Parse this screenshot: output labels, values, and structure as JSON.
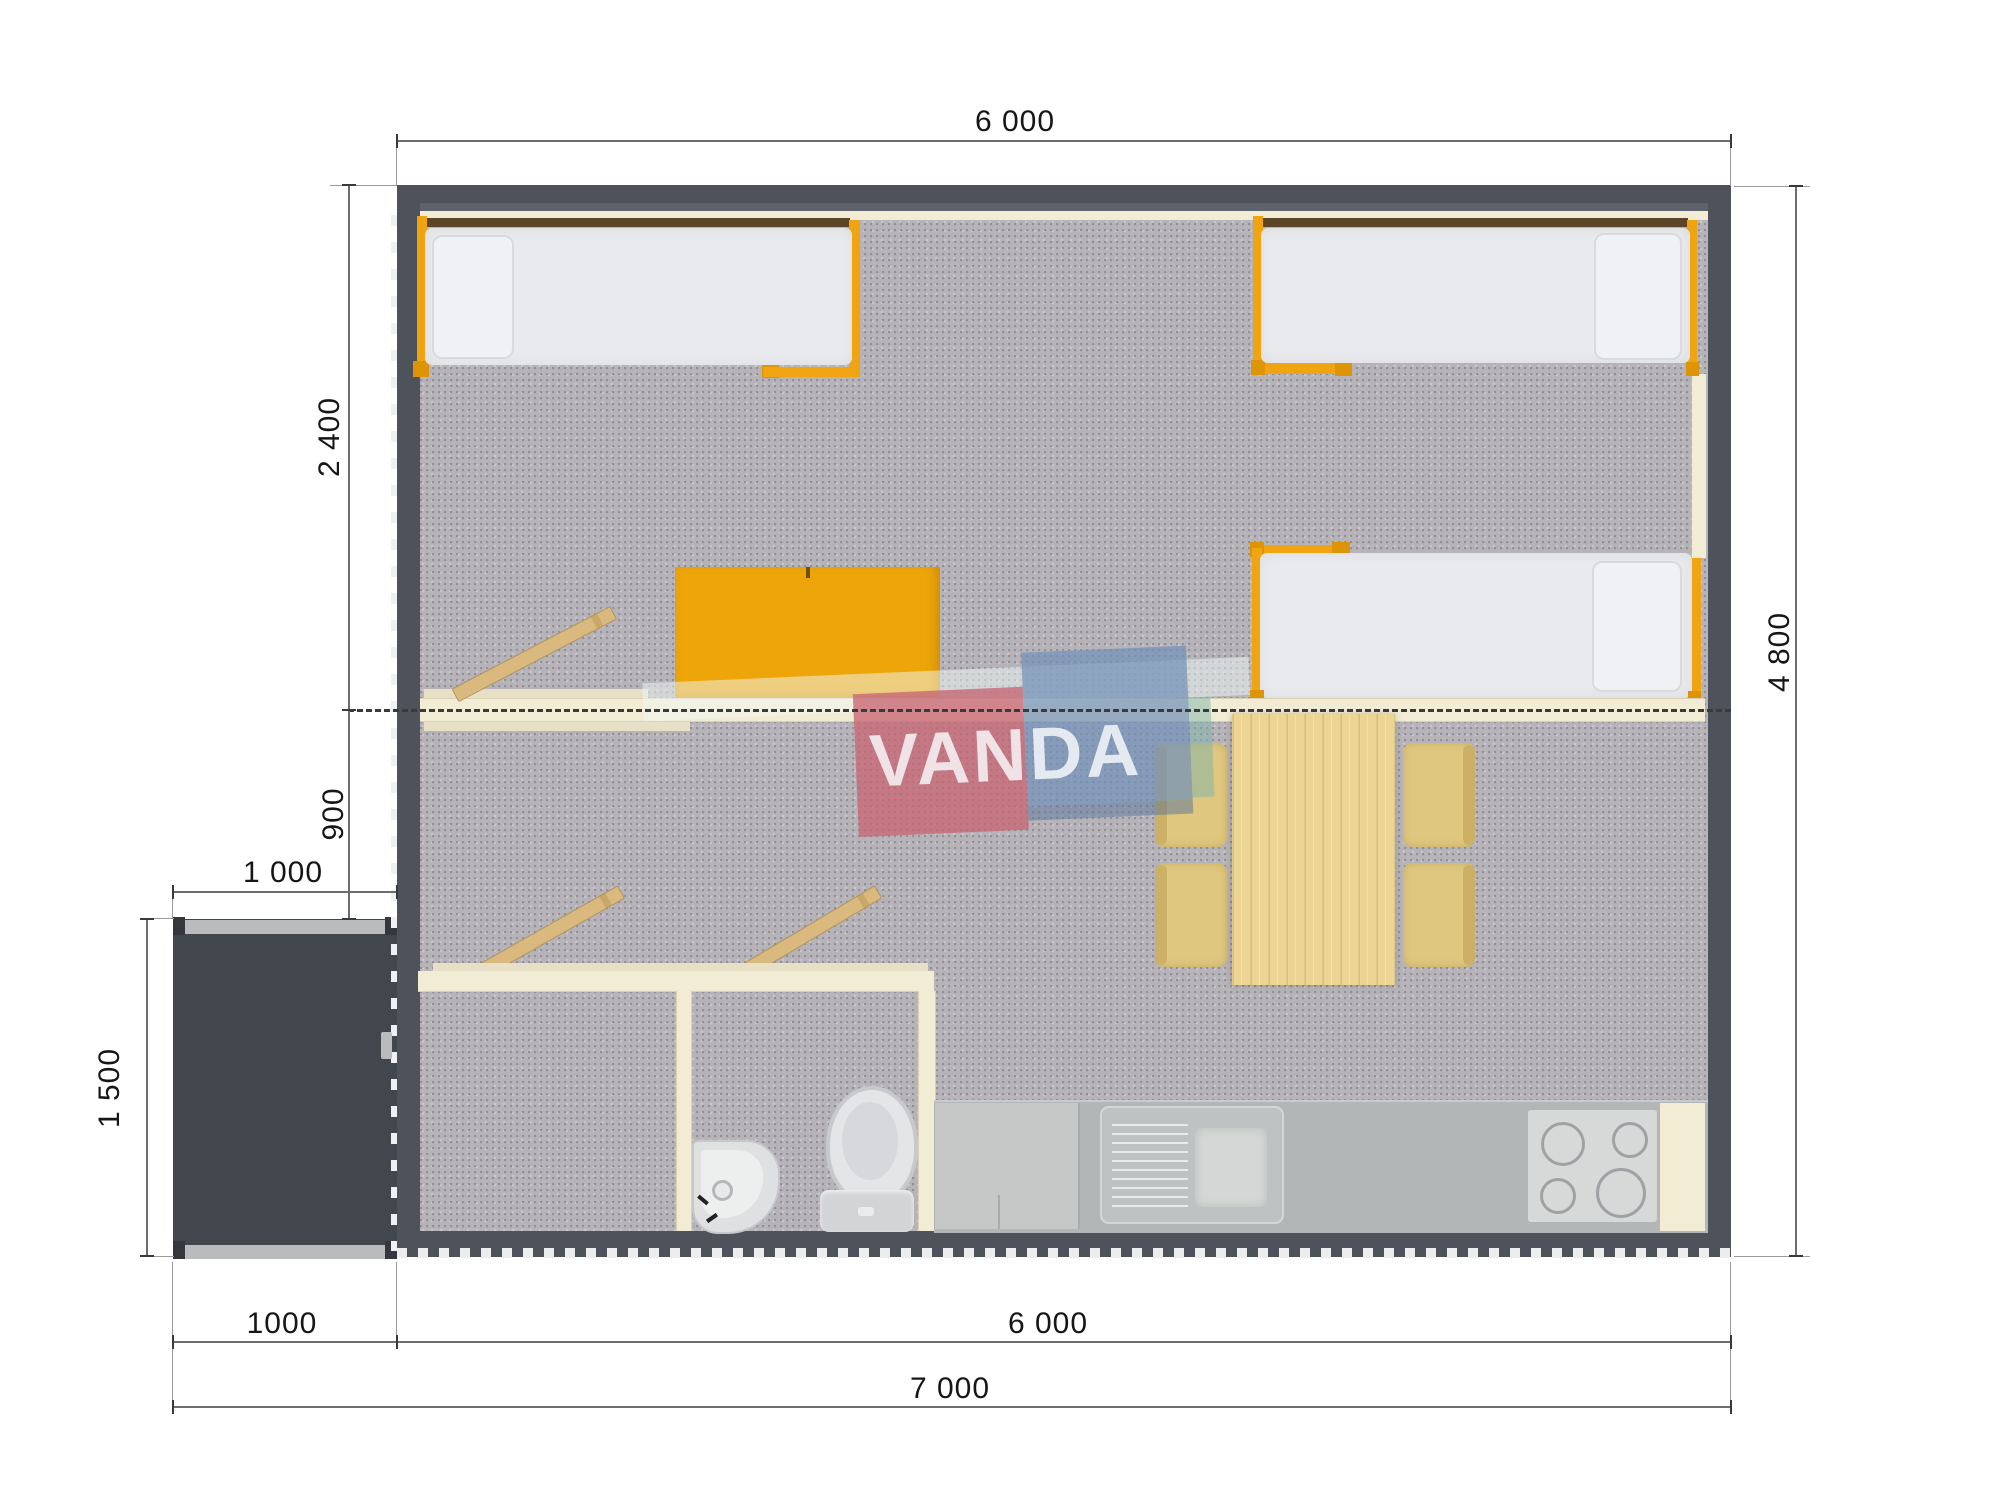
{
  "watermark": {
    "text": "VANDA"
  },
  "dimensions": {
    "top_width": "6 000",
    "left_upper": "2 400",
    "left_lower": "900",
    "porch_width": "1 000",
    "porch_depth": "1 500",
    "bottom_porch": "1000",
    "bottom_main": "6 000",
    "bottom_total": "7 000",
    "right_height": "4 800"
  },
  "colors": {
    "wall": "#4d525b",
    "floor": "#b6b4b9",
    "accent_orange": "#f0a411",
    "partition_cream": "#f2ecd5",
    "watermark_pink": "#c76775",
    "watermark_blue": "#7292b9",
    "counter_gray": "#b2b6b7"
  }
}
